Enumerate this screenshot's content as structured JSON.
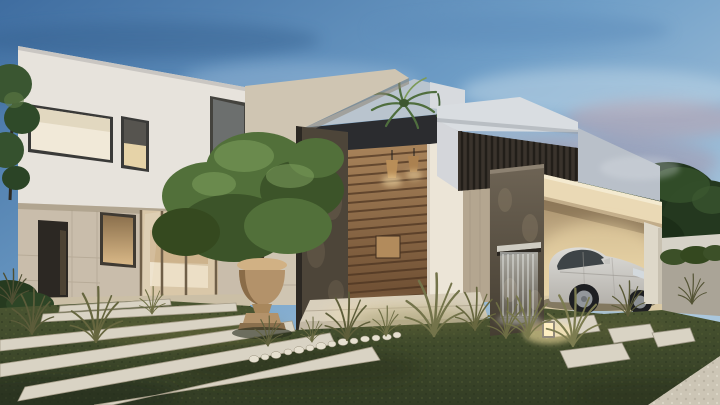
{
  "scene": {
    "type": "architectural-render",
    "time_of_day": "dusk",
    "description": "Photorealistic dusk rendering of a modern luxury villa: white two-storey volume with lit windows, travertine entrance portal with dark stone pier, tall wooden slatted pivot door with wicker pendant lights, palm tree in the inner patio, dark timber louvre box, grey feature wall, carport sheltering a white SUV, dark stone waterfall water feature, and a landscaped front garden with stone plank pathway, stepping pavers, pebble border, ornamental grasses, an olive tree in a classical stone urn and a glowing garden bollard light",
    "objects": [
      "dusk-sky",
      "left-white-villa",
      "upper-floor-windows",
      "stone-ground-floor",
      "glass-vestibule",
      "travertine-entrance-portal",
      "dark-stone-pier",
      "wooden-slat-door",
      "pendant-lights",
      "patio-palm-tree",
      "timber-louvre-box",
      "grey-feature-wall",
      "carport",
      "white-suv",
      "carport-pillar",
      "waterfall-feature",
      "olive-tree-in-urn",
      "plank-walkway",
      "stepping-pavers",
      "pebble-border",
      "ornamental-grasses",
      "bollard-light",
      "background-trees",
      "gravel-corner",
      "lawn"
    ]
  },
  "palette": {
    "sky_top": "#3f6da0",
    "sky_mid": "#6f9ec7",
    "sky_light": "#aac7dd",
    "cloud_pink": "#bfa0ab",
    "cloud_slate": "#7f89a2",
    "facade_white": "#e7e3dc",
    "stone_base": "#c9bdab",
    "travertine": "#cfc5b2",
    "dark_stone": "#4d4539",
    "door_wood_light": "#a8835a",
    "door_wood_dark": "#6b4c31",
    "louver_timber": "#3a332c",
    "concrete_slab": "#d9dde1",
    "feature_wall_grey": "#b9c0c9",
    "carport_fascia": "#ead9b5",
    "interior_glow": "#ecd9ae",
    "car_body": "#dddcd8",
    "glass_dark": "#3e4447",
    "foliage_dark": "#24381f",
    "foliage_mid": "#52703a",
    "foliage_light": "#7fa05e",
    "lawn_top": "#4a5531",
    "lawn_bottom": "#333d25",
    "paver_light": "#d9d3c4",
    "gravel": "#ccc5b5",
    "urn_stone": "#d1b184",
    "water_white": "#f4f7f4",
    "bollard_glow": "#ffe9a8"
  }
}
